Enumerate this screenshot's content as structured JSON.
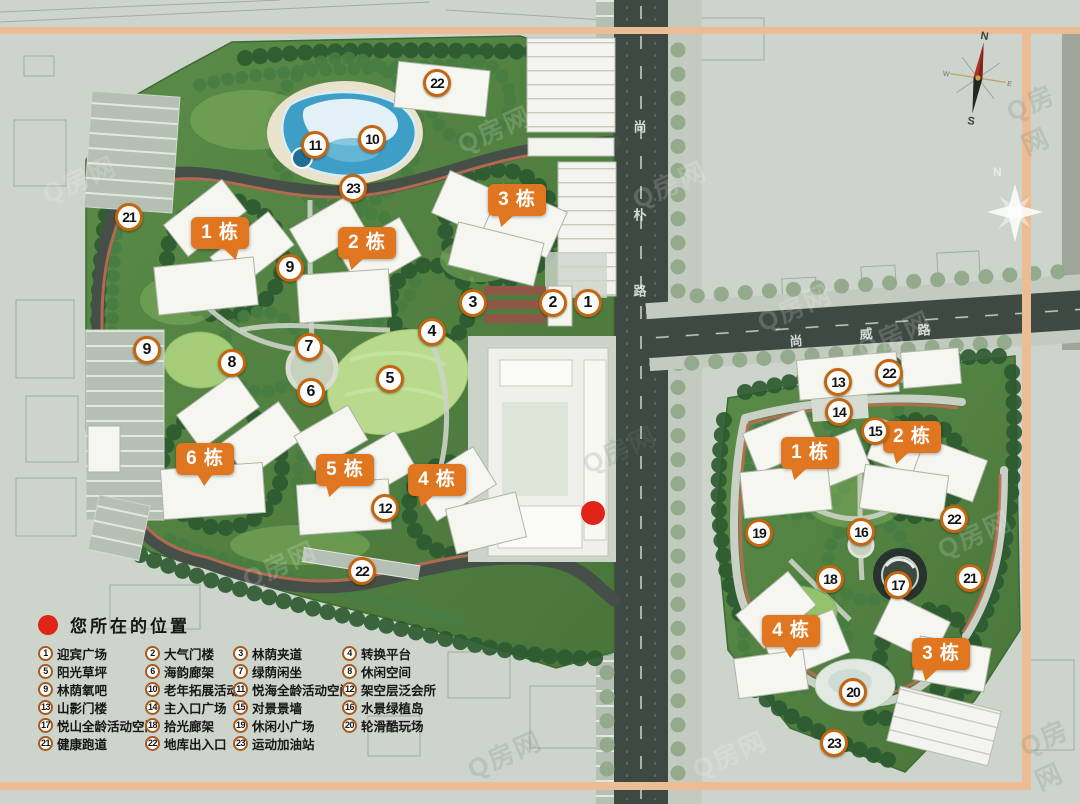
{
  "legend": {
    "title": "您所在的位置",
    "items": [
      {
        "n": "1",
        "label": "迎宾广场"
      },
      {
        "n": "2",
        "label": "大气门楼"
      },
      {
        "n": "3",
        "label": "林荫夹道"
      },
      {
        "n": "4",
        "label": "转换平台"
      },
      {
        "n": "5",
        "label": "阳光草坪"
      },
      {
        "n": "6",
        "label": "海韵廊架"
      },
      {
        "n": "7",
        "label": "绿荫闲坐"
      },
      {
        "n": "8",
        "label": "休闲空间"
      },
      {
        "n": "9",
        "label": "林荫氧吧"
      },
      {
        "n": "10",
        "label": "老年拓展活动"
      },
      {
        "n": "11",
        "label": "悦海全龄活动空间"
      },
      {
        "n": "12",
        "label": "架空层泛会所"
      },
      {
        "n": "13",
        "label": "山影门楼"
      },
      {
        "n": "14",
        "label": "主入口广场"
      },
      {
        "n": "15",
        "label": "对景景墙"
      },
      {
        "n": "16",
        "label": "水景绿植岛"
      },
      {
        "n": "17",
        "label": "悦山全龄活动空间"
      },
      {
        "n": "18",
        "label": "拾光廊架"
      },
      {
        "n": "19",
        "label": "休闲小广场"
      },
      {
        "n": "20",
        "label": "轮滑酷玩场"
      },
      {
        "n": "21",
        "label": "健康跑道"
      },
      {
        "n": "22",
        "label": "地库出入口"
      },
      {
        "n": "23",
        "label": "运动加油站"
      }
    ]
  },
  "roads": {
    "vertical": {
      "name": "尚朴路",
      "chars": [
        "尚",
        "朴",
        "路"
      ]
    },
    "horizontal": {
      "name": "尚威路",
      "chars": [
        "尚",
        "威",
        "路"
      ]
    }
  },
  "compass": {
    "n": "N",
    "s": "S",
    "w": "W",
    "e": "E"
  },
  "north_hint": "N",
  "watermark": "Q房网",
  "location_dot": {
    "x": 593,
    "y": 513
  },
  "markers": [
    {
      "n": "22",
      "x": 437,
      "y": 83
    },
    {
      "n": "11",
      "x": 315,
      "y": 145
    },
    {
      "n": "10",
      "x": 372,
      "y": 139
    },
    {
      "n": "23",
      "x": 353,
      "y": 188
    },
    {
      "n": "21",
      "x": 129,
      "y": 217
    },
    {
      "n": "9",
      "x": 290,
      "y": 268
    },
    {
      "n": "3",
      "x": 473,
      "y": 303
    },
    {
      "n": "2",
      "x": 553,
      "y": 303
    },
    {
      "n": "1",
      "x": 588,
      "y": 303
    },
    {
      "n": "4",
      "x": 432,
      "y": 332
    },
    {
      "n": "9",
      "x": 147,
      "y": 350
    },
    {
      "n": "7",
      "x": 309,
      "y": 347
    },
    {
      "n": "8",
      "x": 232,
      "y": 363
    },
    {
      "n": "5",
      "x": 390,
      "y": 379
    },
    {
      "n": "6",
      "x": 311,
      "y": 392
    },
    {
      "n": "12",
      "x": 385,
      "y": 508
    },
    {
      "n": "22",
      "x": 362,
      "y": 571
    },
    {
      "n": "13",
      "x": 838,
      "y": 382
    },
    {
      "n": "22",
      "x": 889,
      "y": 373
    },
    {
      "n": "14",
      "x": 839,
      "y": 412
    },
    {
      "n": "15",
      "x": 875,
      "y": 431
    },
    {
      "n": "19",
      "x": 759,
      "y": 533
    },
    {
      "n": "16",
      "x": 861,
      "y": 532
    },
    {
      "n": "22",
      "x": 954,
      "y": 519
    },
    {
      "n": "18",
      "x": 830,
      "y": 579
    },
    {
      "n": "17",
      "x": 898,
      "y": 585
    },
    {
      "n": "21",
      "x": 970,
      "y": 578
    },
    {
      "n": "20",
      "x": 853,
      "y": 692
    },
    {
      "n": "23",
      "x": 834,
      "y": 743
    }
  ],
  "building_labels": [
    {
      "text": "1 栋",
      "x": 220,
      "y": 233,
      "tail": "br"
    },
    {
      "text": "2 栋",
      "x": 367,
      "y": 243,
      "tail": "bl"
    },
    {
      "text": "3 栋",
      "x": 517,
      "y": 200,
      "tail": "bl"
    },
    {
      "text": "6 栋",
      "x": 205,
      "y": 459,
      "tail": "c"
    },
    {
      "text": "5 栋",
      "x": 345,
      "y": 470,
      "tail": "bl"
    },
    {
      "text": "4 栋",
      "x": 437,
      "y": 480,
      "tail": "bl"
    },
    {
      "text": "1 栋",
      "x": 810,
      "y": 453,
      "tail": "bl"
    },
    {
      "text": "2 栋",
      "x": 912,
      "y": 437,
      "tail": "bl"
    },
    {
      "text": "4 栋",
      "x": 791,
      "y": 631,
      "tail": "c"
    },
    {
      "text": "3 栋",
      "x": 941,
      "y": 654,
      "tail": "bl"
    }
  ],
  "colors": {
    "accent_orange": "#e0761f",
    "marker_ring": "#c4660f",
    "location_red": "#e02417",
    "frame_band": "#ecbc94",
    "road": "#3e4943",
    "plot_green": "#517e40",
    "pool_blue": "#3e9ec6",
    "lawn_green": "#b9da8c",
    "background": "#ccd4cb"
  }
}
